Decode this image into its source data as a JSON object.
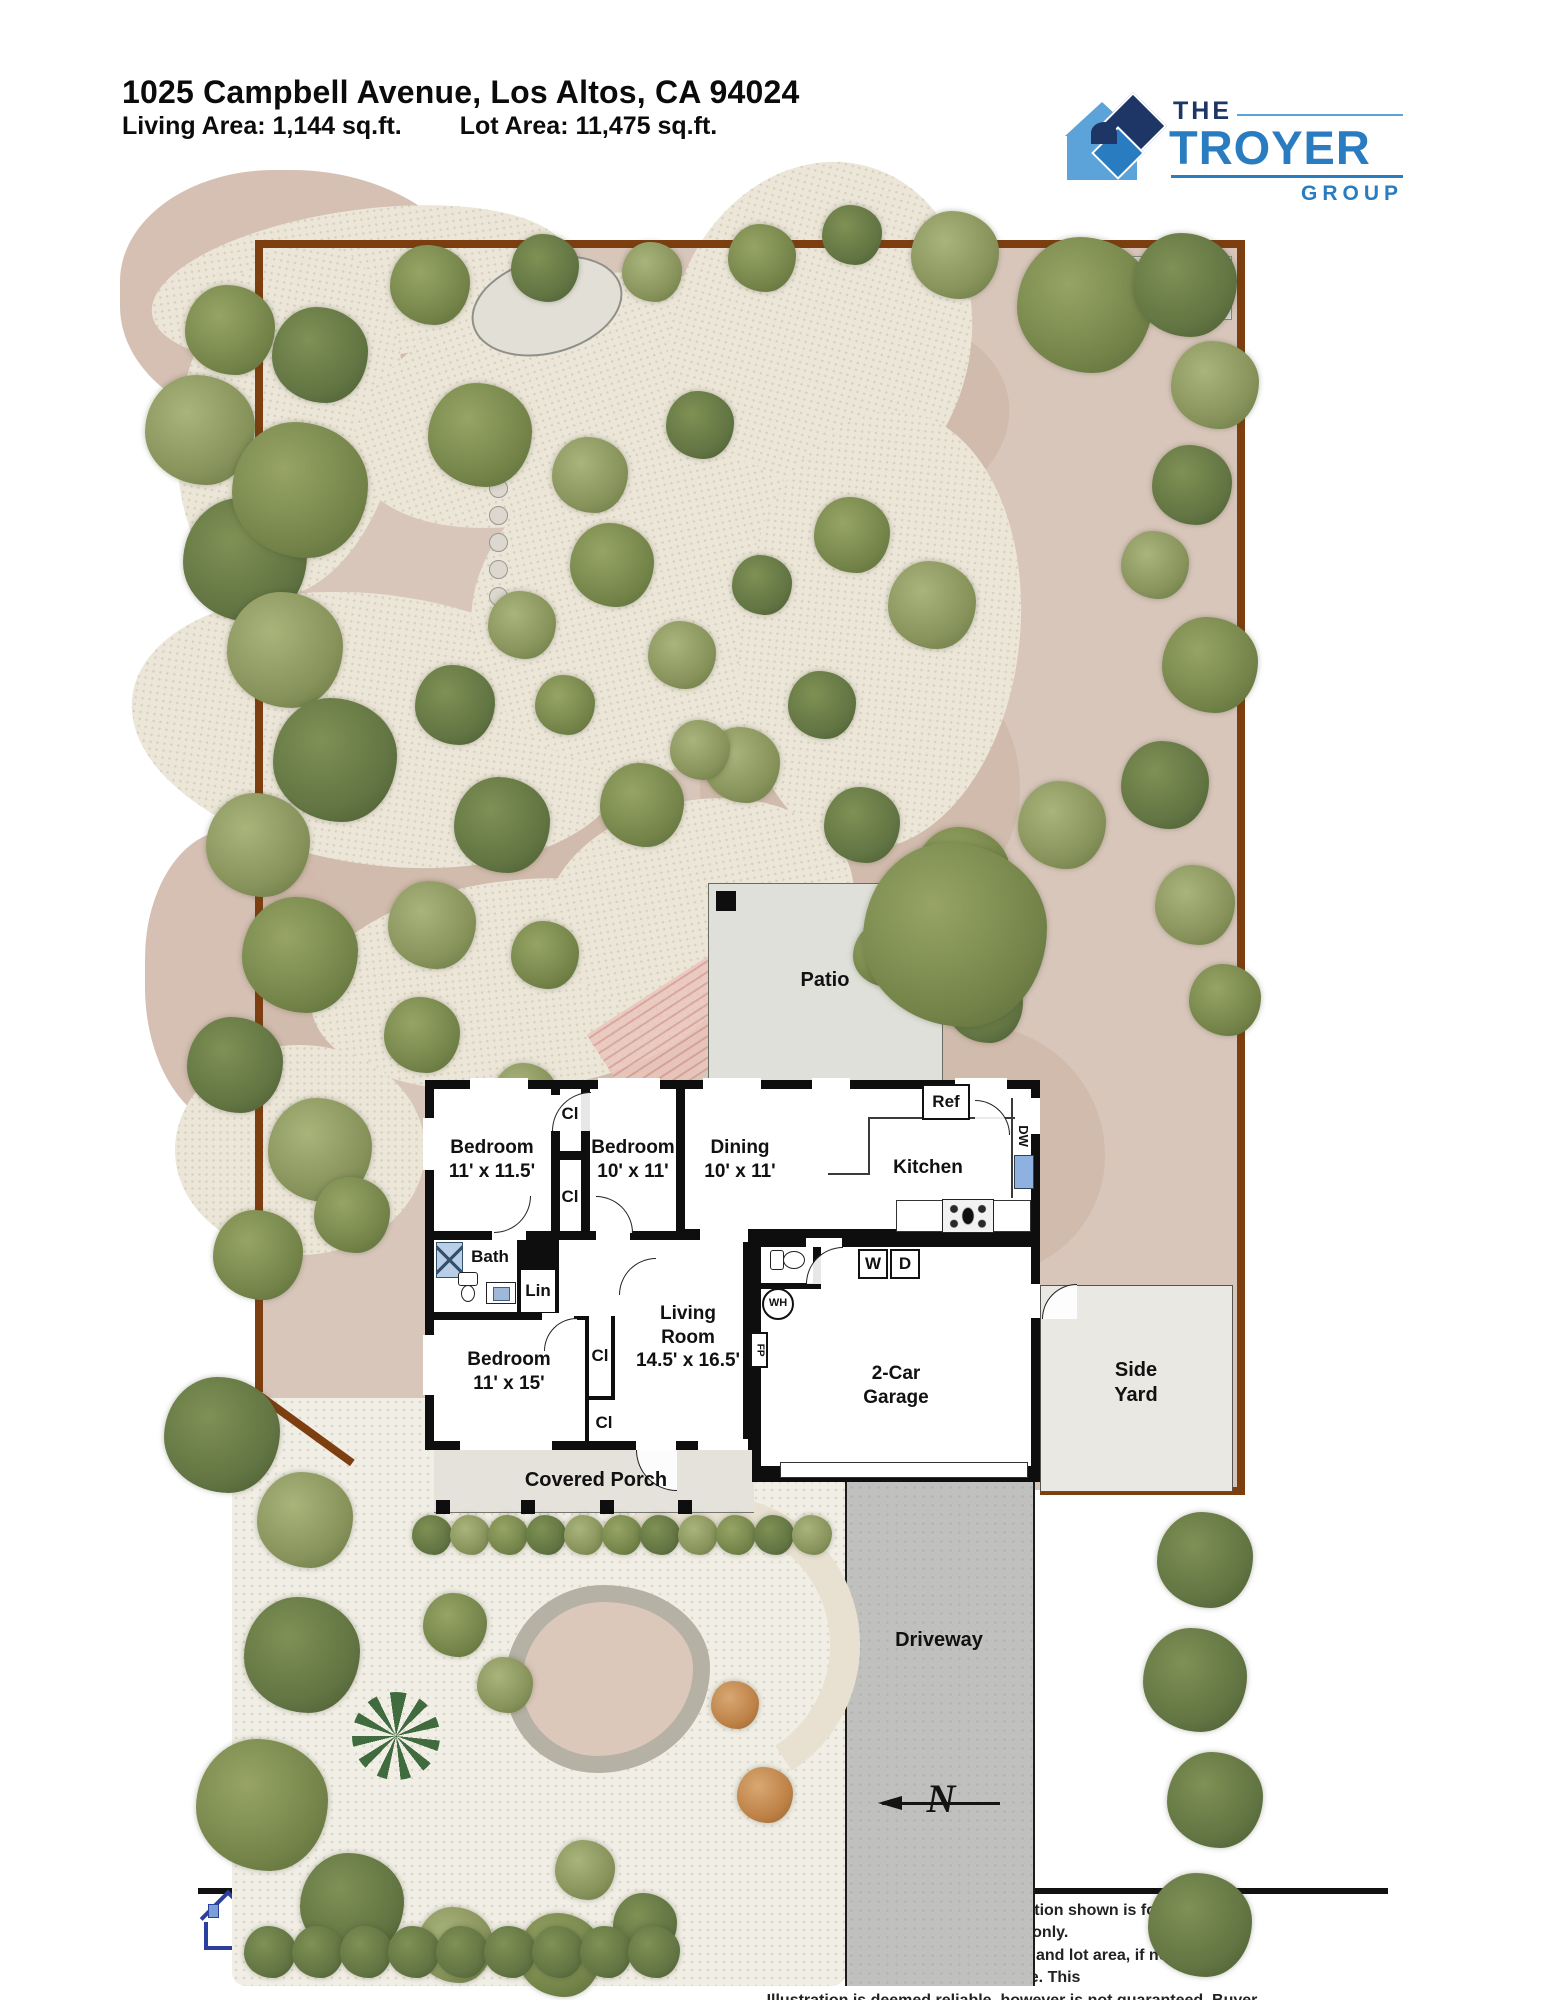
{
  "header": {
    "address": "1025 Campbell Avenue, Los Altos, CA 94024",
    "living_area": "Living Area: 1,144 sq.ft.",
    "lot_area": "Lot Area: 11,475 sq.ft."
  },
  "logo": {
    "line1": "THE",
    "line2": "TROYER",
    "line3": "GROUP",
    "colors": {
      "navy": "#1e3666",
      "blue": "#2a7cc0",
      "light_blue": "#5ba3d9"
    }
  },
  "plan": {
    "patio": "Patio",
    "covered_porch": "Covered Porch",
    "side_yard": "Side Yard",
    "driveway": "Driveway",
    "north": "N",
    "rooms": {
      "bed1": {
        "name": "Bedroom",
        "dims": "11' x 11.5'"
      },
      "bed2": {
        "name": "Bedroom",
        "dims": "10' x 11'"
      },
      "dining": {
        "name": "Dining",
        "dims": "10' x 11'"
      },
      "kitchen": {
        "name": "Kitchen"
      },
      "bed3": {
        "name": "Bedroom",
        "dims": "11' x 15'"
      },
      "living": {
        "name": "Living Room",
        "dims": "14.5' x 16.5'"
      },
      "garage": {
        "name": "2-Car Garage"
      }
    },
    "fixtures": {
      "ref": "Ref",
      "dw": "DW",
      "bath": "Bath",
      "lin": "Lin",
      "cl": "Cl",
      "wh": "WH",
      "fp": "FP",
      "washer": "W",
      "dryer": "D"
    },
    "colors": {
      "lot_border": "#7d3f10",
      "backyard_ground": "#d8c6ba",
      "path": "#ece6d8",
      "patio_gray": "#e4e3dd",
      "driveway_gray": "#c0c0be",
      "appliance_blue": "#8fb1e0"
    }
  },
  "footer": {
    "credit": "HASSketch Floor Plan Illustrations",
    "copyright": "© Kimberly Townsend",
    "disclaimer": [
      "Disclaimer: The floor plan illustration shown is for marketing purposes only.",
      "Room Dimensions, living area, and lot area, if noted, are approximate. This",
      "Illustration is deemed reliable, however is not guaranteed. Buyer to verify."
    ]
  }
}
